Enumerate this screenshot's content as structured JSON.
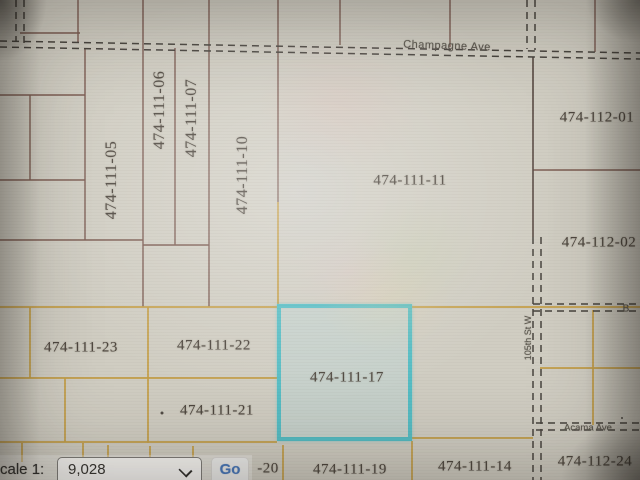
{
  "streets": {
    "champagne_ave": "Champagne Ave",
    "acama_ave": "Acama Ave",
    "street_105th": "105th St W",
    "street_b_partial": "B"
  },
  "parcels": {
    "p05": "474-111-05",
    "p06": "474-111-06",
    "p07": "474-111-07",
    "p10": "474-111-10",
    "p11": "474-111-11",
    "p112_01": "474-112-01",
    "p112_02": "474-112-02",
    "p23": "474-111-23",
    "p22": "474-111-22",
    "p17": "474-111-17",
    "p21": "474-111-21",
    "p20_partial": "-20",
    "p19": "474-111-19",
    "p14": "474-111-14",
    "p112_24": "474-112-24"
  },
  "controls": {
    "scale_label": "Scale 1:",
    "scale_value": "9,028",
    "go_button": "Go"
  },
  "icons": {
    "dropdown_chevron": "chevron-down"
  },
  "colors": {
    "highlight_border": "#53bcc3",
    "parcel_line_upper": "#7b5a50",
    "parcel_line_lower": "#c39d45",
    "road_casing": "#45413b",
    "go_text": "#4878ba"
  }
}
